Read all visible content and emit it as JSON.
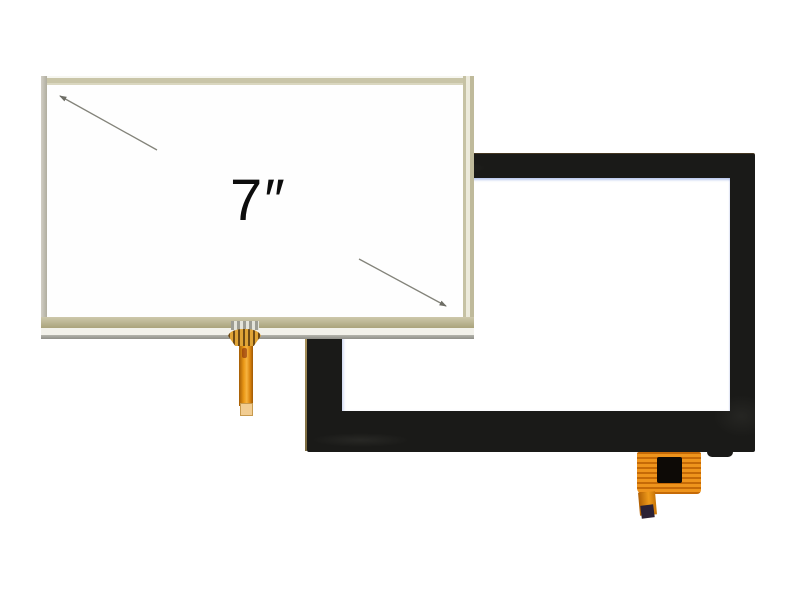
{
  "scene": {
    "type": "product-photo",
    "background_color": "#ffffff"
  },
  "resistive_panel": {
    "name": "7-inch resistive touch screen panel",
    "size_label": "7″",
    "face_color": "#fefefe",
    "frame_top_color": "#c9c5a8",
    "frame_left_color": "#b0ad9f",
    "frame_right_color": "#c6c2a4",
    "frame_bottom_tan_color": "#aaa37c",
    "bottom_edge_gray_color": "#8f8f89",
    "diagonal_arrow_color": "#83837a",
    "fpc": {
      "cable_color": "#ec9a18",
      "crimp_gold_color": "#e0a436",
      "crimp_stripe_color": "#6f4b15",
      "tab_color": "#9d9d93",
      "tip_color": "#f2cd92"
    }
  },
  "capacitive_panel": {
    "name": "capacitive touch screen panel",
    "bezel_color": "#1a1a18",
    "window_color": "#ffffff",
    "window_edge_tint_color": "#92a7dc",
    "fpc": {
      "cable_color": "#e8860b",
      "chip_color": "#0d0a06",
      "tail_tip_color": "#2b2135"
    }
  }
}
